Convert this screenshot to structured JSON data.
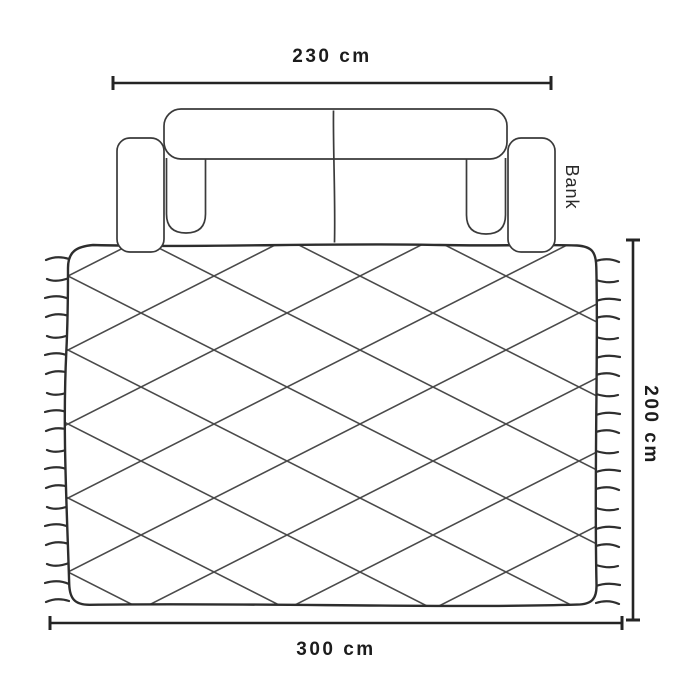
{
  "diagram": {
    "sofa": {
      "label": "Bank",
      "width_label": "230 cm"
    },
    "rug": {
      "width_label": "300 cm",
      "depth_label": "200 cm"
    }
  },
  "colors": {
    "background": "#ffffff",
    "sketch_line": "#3a3a3a",
    "pattern_line": "#4a4a4a",
    "dimension_line": "#242424",
    "text": "#1c1c1c"
  }
}
